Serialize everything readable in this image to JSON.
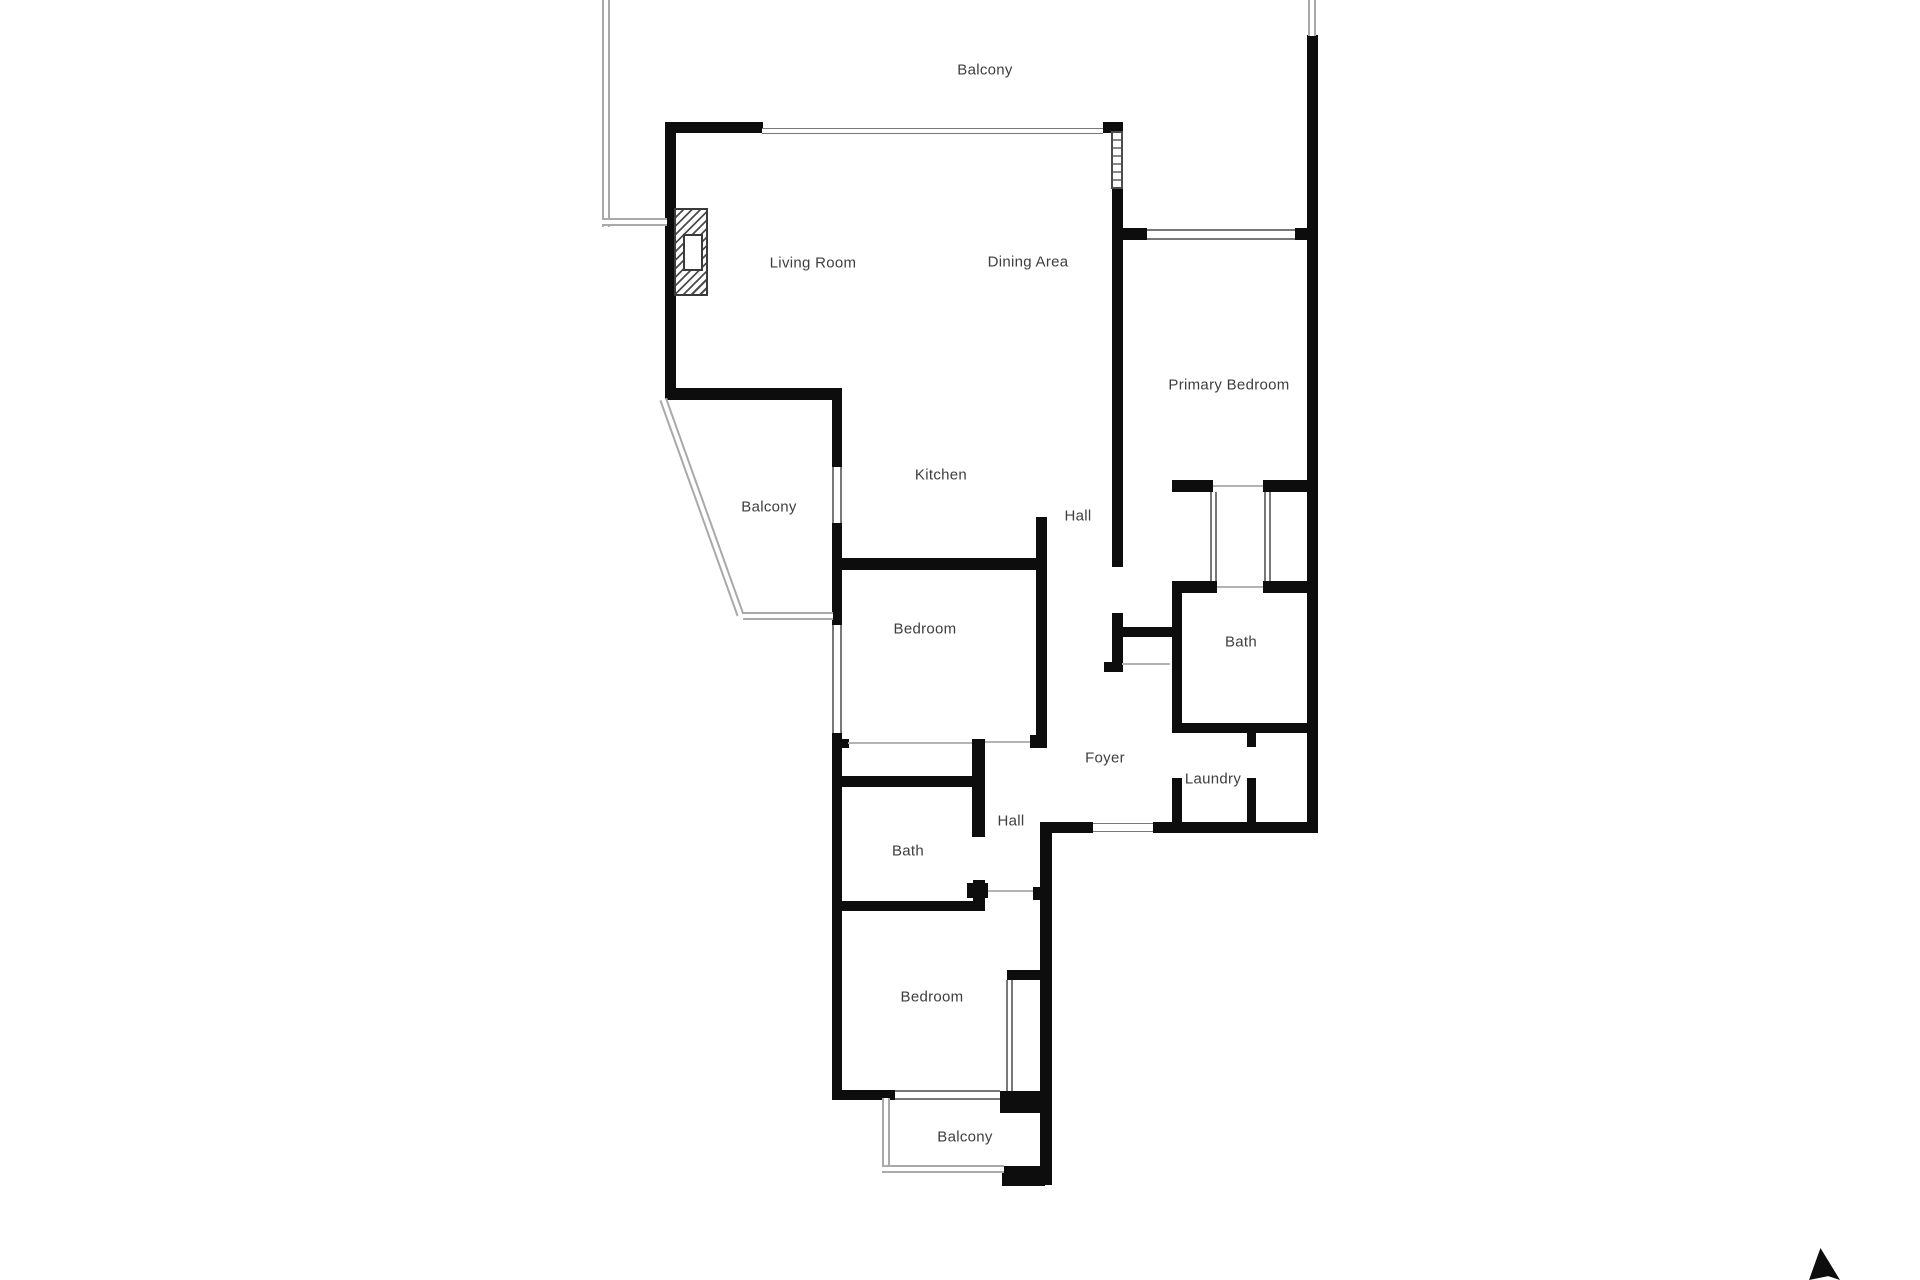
{
  "document": {
    "type": "residential-floor-plan",
    "style": "black-wall 2D plan, no furniture, balconies drawn with thin railings"
  },
  "labels": {
    "balcony_top": "Balcony",
    "living_room": "Living Room",
    "dining_area": "Dining Area",
    "primary_bedroom": "Primary Bedroom",
    "kitchen": "Kitchen",
    "balcony_left": "Balcony",
    "hall_upper": "Hall",
    "bedroom_middle": "Bedroom",
    "bath_primary": "Bath",
    "foyer": "Foyer",
    "laundry": "Laundry",
    "hall_lower": "Hall",
    "bath_lower": "Bath",
    "bedroom_lower": "Bedroom",
    "balcony_lower": "Balcony"
  },
  "icons": {
    "arrow_marker": "north-arrow"
  },
  "colors": {
    "wall": "#0d0d0d",
    "railing": "#a9a9a9",
    "glass": "#787878",
    "label_text": "#3e3e3e",
    "background": "#ffffff"
  }
}
